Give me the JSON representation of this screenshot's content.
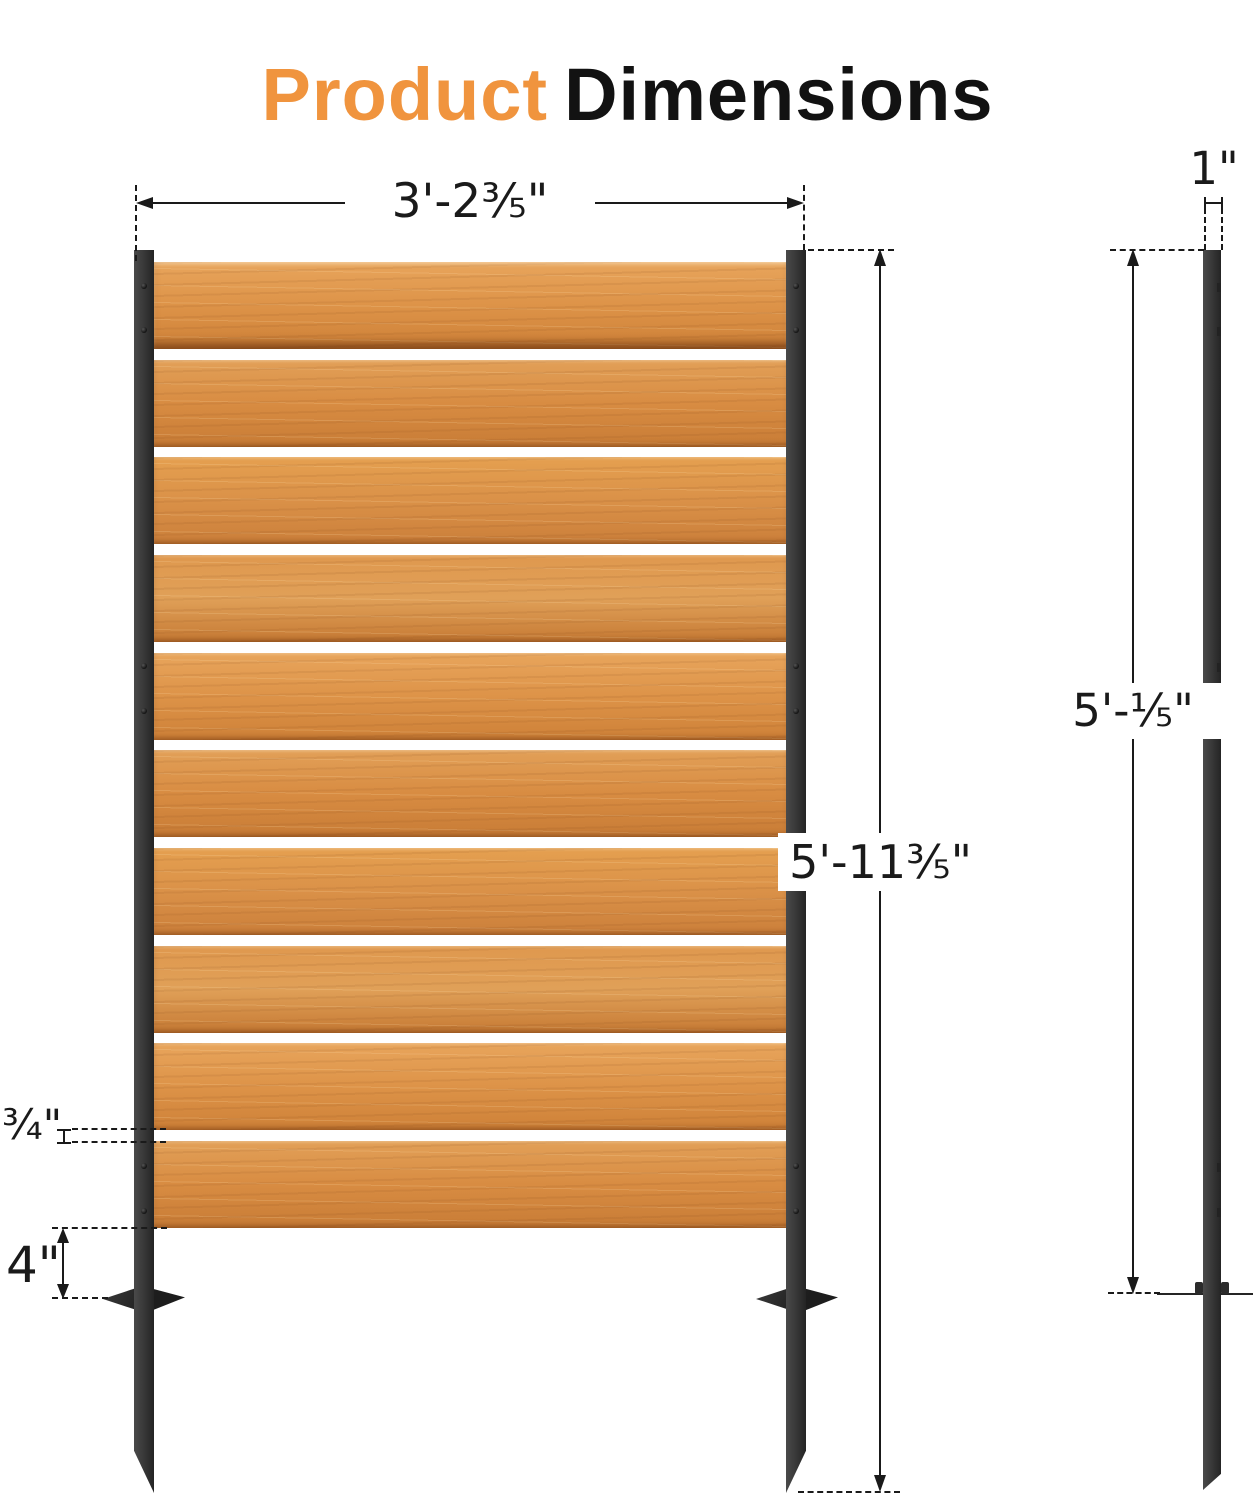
{
  "title": {
    "highlight": "Product",
    "rest": "Dimensions"
  },
  "front_view": {
    "width_label": "3'-2⅗\"",
    "height_label": "5'-11⅗\"",
    "slat_gap_label": "¾\"",
    "stake_height_label": "4\"",
    "slat_count": 10,
    "gap_count": 9
  },
  "side_view": {
    "thickness_label": "1\"",
    "height_label": "5'-⅕\""
  },
  "colors": {
    "accent_orange": "#F0943E",
    "title_ink": "#121212",
    "dimension_line": "#1a1a1a",
    "post_dark": "#333333",
    "background": "#ffffff",
    "slat_palettes": [
      {
        "light": "#E8A55C",
        "mid": "#DD9348",
        "dark": "#CE8138"
      },
      {
        "light": "#E2A058",
        "mid": "#D88C42",
        "dark": "#C87C36"
      },
      {
        "light": "#E5A050",
        "mid": "#DA9148",
        "dark": "#CB7F3A"
      },
      {
        "light": "#DF984E",
        "mid": "#E0A058",
        "dark": "#C67A34"
      }
    ]
  }
}
